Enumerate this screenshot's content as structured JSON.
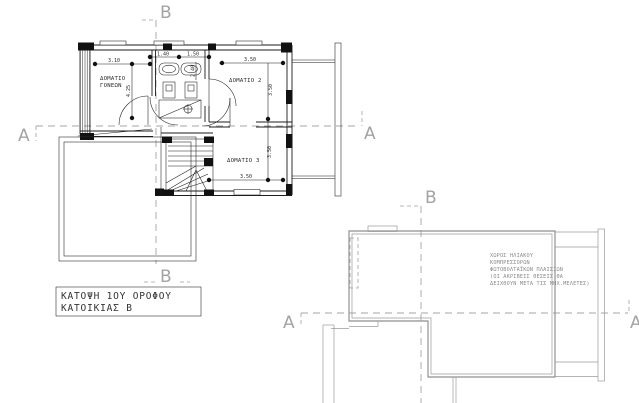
{
  "drawing_type": "architectural-floor-plans",
  "plan1": {
    "title": {
      "line1": "ΚΑΤΟΨΗ 1ΟΥ ΟΡΟΦΟΥ",
      "line2": "ΚΑΤΟΙΚΙΑΣ Β"
    },
    "rooms": {
      "parents_line1": "ΔΟΜΑΤΙΟ",
      "parents_line2": "ΓΟΝΕΩΝ",
      "room2": "ΔΟΜΑΤΙΟ 2",
      "room3": "ΔΟΜΑΤΙΟ 3"
    },
    "dims": {
      "top_left": "3.10",
      "top_mid1": "1.40",
      "top_mid2": "1.50",
      "top_right": "3.50",
      "left_vertical": "4.25",
      "bath_vertical": "2.40",
      "room2_vertical": "3.50",
      "room3_vertical": "3.50",
      "room3_bottom": "3.50"
    }
  },
  "plan2": {
    "note": {
      "line1": "ΧΩΡΟΣ ΗΛΙΑΚΟΥ",
      "line2": "ΚΟΜΠΡΕΣΣΟΡΩΝ",
      "line3": "ΦΩΤΟΒΟΛΤΑΪΚΩΝ ΠΛΑΙΣΙΩΝ",
      "line4": "(ΟΙ ΑΚΡΙΒΕΙΣ ΘΕΣΕΙΣ ΘΑ",
      "line5": "ΔΕΙΧΘΟΥΝ ΜΕΤΑ ΤΙΣ ΜΗΧ.ΜΕΛΕΤΕΣ)"
    }
  },
  "markers": {
    "a": "A",
    "b": "B"
  },
  "colors": {
    "background": "#ffffff",
    "plan1_line": "#1c1c1c",
    "plan2_line": "#8f8f8f",
    "section_dash": "#a6a6a6",
    "marker_text": "#a3a3a3",
    "dim_text": "#2b2b2b",
    "note_text": "#8a8a8a"
  }
}
